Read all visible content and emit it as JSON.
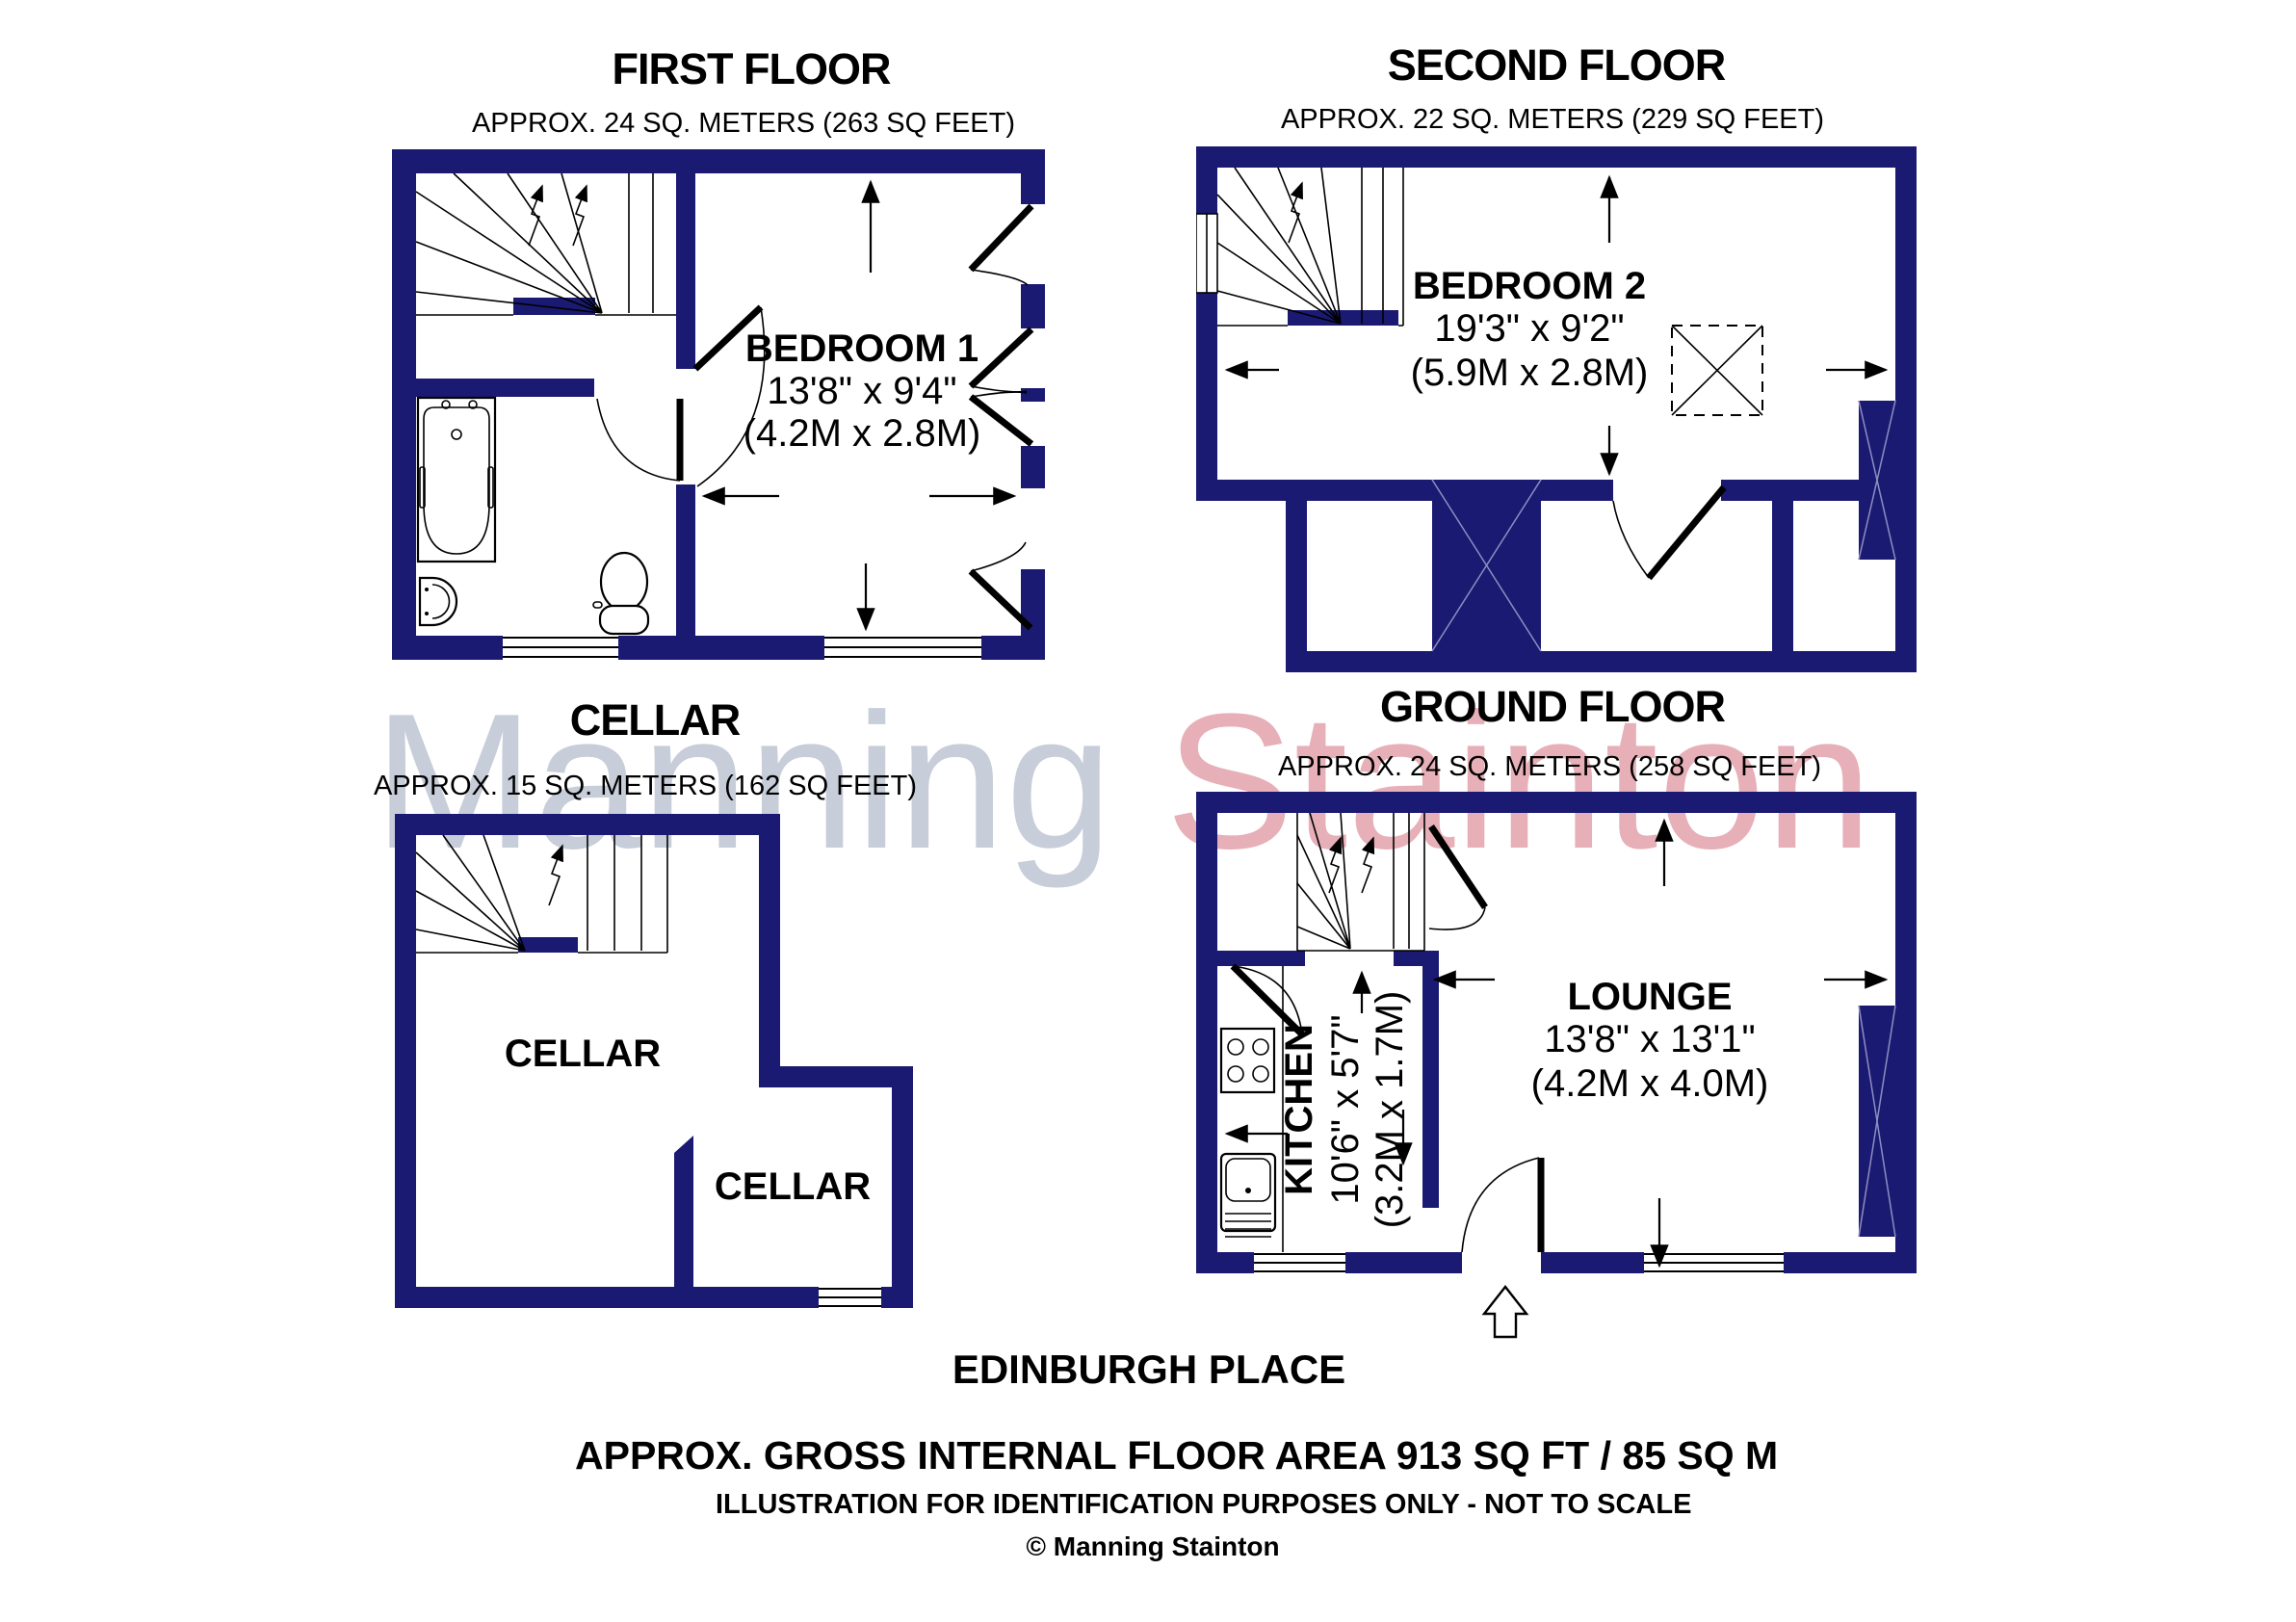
{
  "floors": [
    {
      "id": "first",
      "title": "FIRST FLOOR",
      "subtitle": "APPROX. 24 SQ. METERS (263 SQ FEET)",
      "rooms": [
        {
          "name": "BEDROOM 1",
          "dim_imperial": "13'8\" x 9'4\"",
          "dim_metric": "(4.2M x 2.8M)"
        }
      ]
    },
    {
      "id": "second",
      "title": "SECOND FLOOR",
      "subtitle": "APPROX. 22 SQ. METERS (229 SQ FEET)",
      "rooms": [
        {
          "name": "BEDROOM 2",
          "dim_imperial": "19'3\" x 9'2\"",
          "dim_metric": "(5.9M x 2.8M)"
        }
      ]
    },
    {
      "id": "cellar",
      "title": "CELLAR",
      "subtitle": "APPROX. 15 SQ. METERS (162 SQ FEET)",
      "rooms": [
        {
          "name": "CELLAR"
        },
        {
          "name": "CELLAR"
        }
      ]
    },
    {
      "id": "ground",
      "title": "GROUND FLOOR",
      "subtitle": "APPROX. 24 SQ. METERS (258 SQ FEET)",
      "rooms": [
        {
          "name": "LOUNGE",
          "dim_imperial": "13'8\" x 13'1\"",
          "dim_metric": "(4.2M x 4.0M)"
        },
        {
          "name": "KITCHEN",
          "dim_imperial": "10'6\" x 5'7\"",
          "dim_metric": "(3.2M x 1.7M)"
        }
      ]
    }
  ],
  "footer": {
    "address": "EDINBURGH PLACE",
    "area_summary": "APPROX. GROSS INTERNAL FLOOR AREA 913 SQ FT / 85 SQ M",
    "disclaimer": "ILLUSTRATION FOR IDENTIFICATION PURPOSES ONLY - NOT TO SCALE",
    "copyright": "© Manning Stainton"
  },
  "watermark": {
    "word1": "Manning",
    "word2": "Stainton",
    "color1": "#c7cdd9",
    "color2": "#e7afb7"
  },
  "colors": {
    "wall": "#1a1a72"
  }
}
